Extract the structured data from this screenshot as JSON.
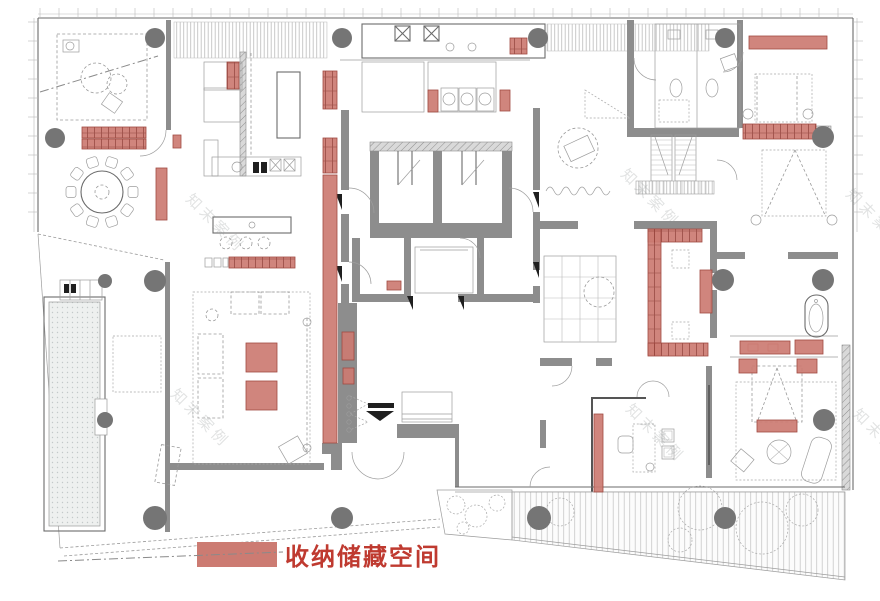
{
  "legend": {
    "label": "收纳储藏空间",
    "swatch_color": "#cc7b72",
    "text_color": "#bf3a30",
    "swatch": {
      "x": 197,
      "y": 542,
      "w": 80,
      "h": 25
    },
    "label_pos": {
      "x": 285,
      "y": 565
    },
    "leader": {
      "x1": 58,
      "y1": 561,
      "x2": 283,
      "y2": 552
    }
  },
  "palette": {
    "storage_fill": "#cc7b72",
    "storage_stroke": "#a14a42",
    "storage_dark": "#96423a",
    "wall": "#8d8d8d",
    "column": "#757575",
    "line": "#6b6b6b",
    "light": "#9d9d9d",
    "legend_text": "#bf3a30"
  },
  "watermark": {
    "text": "知末案例",
    "positions": [
      {
        "x": 185,
        "y": 200
      },
      {
        "x": 620,
        "y": 175
      },
      {
        "x": 845,
        "y": 195
      },
      {
        "x": 170,
        "y": 395
      },
      {
        "x": 625,
        "y": 410
      },
      {
        "x": 852,
        "y": 415
      }
    ]
  },
  "plan": {
    "storage_areas": [
      {
        "x": 82,
        "y": 127,
        "w": 64,
        "h": 11,
        "pattern": "stripe"
      },
      {
        "x": 82,
        "y": 139,
        "w": 64,
        "h": 10,
        "pattern": "stripe"
      },
      {
        "x": 173,
        "y": 135,
        "w": 8,
        "h": 13,
        "pattern": "solid"
      },
      {
        "x": 156,
        "y": 168,
        "w": 11,
        "h": 52,
        "pattern": "solid"
      },
      {
        "x": 227,
        "y": 62,
        "w": 12,
        "h": 27,
        "pattern": "stripe"
      },
      {
        "x": 323,
        "y": 71,
        "w": 14,
        "h": 38,
        "pattern": "stripe"
      },
      {
        "x": 323,
        "y": 138,
        "w": 14,
        "h": 35,
        "pattern": "stripe"
      },
      {
        "x": 323,
        "y": 175,
        "w": 14,
        "h": 268,
        "pattern": "solid"
      },
      {
        "x": 342,
        "y": 332,
        "w": 12,
        "h": 28,
        "pattern": "solid"
      },
      {
        "x": 343,
        "y": 368,
        "w": 11,
        "h": 16,
        "pattern": "solid"
      },
      {
        "x": 229,
        "y": 257,
        "w": 66,
        "h": 11,
        "pattern": "stripe"
      },
      {
        "x": 510,
        "y": 38,
        "w": 17,
        "h": 16,
        "pattern": "stripe"
      },
      {
        "x": 428,
        "y": 90,
        "w": 10,
        "h": 22,
        "pattern": "solid"
      },
      {
        "x": 500,
        "y": 90,
        "w": 10,
        "h": 21,
        "pattern": "solid"
      },
      {
        "x": 749,
        "y": 36,
        "w": 78,
        "h": 13,
        "pattern": "solid"
      },
      {
        "x": 743,
        "y": 124,
        "w": 73,
        "h": 15,
        "pattern": "stripe"
      },
      {
        "x": 648,
        "y": 229,
        "w": 54,
        "h": 13,
        "pattern": "stripe"
      },
      {
        "x": 648,
        "y": 229,
        "w": 13,
        "h": 126,
        "pattern": "stripe"
      },
      {
        "x": 648,
        "y": 343,
        "w": 60,
        "h": 13,
        "pattern": "stripe"
      },
      {
        "x": 700,
        "y": 270,
        "w": 12,
        "h": 43,
        "pattern": "solid"
      },
      {
        "x": 594,
        "y": 414,
        "w": 9,
        "h": 78,
        "pattern": "solid"
      },
      {
        "x": 246,
        "y": 343,
        "w": 31,
        "h": 29,
        "pattern": "solid"
      },
      {
        "x": 246,
        "y": 381,
        "w": 31,
        "h": 29,
        "pattern": "solid"
      },
      {
        "x": 740,
        "y": 341,
        "w": 50,
        "h": 13,
        "pattern": "solid"
      },
      {
        "x": 795,
        "y": 340,
        "w": 28,
        "h": 14,
        "pattern": "solid"
      },
      {
        "x": 739,
        "y": 359,
        "w": 18,
        "h": 14,
        "pattern": "solid"
      },
      {
        "x": 797,
        "y": 359,
        "w": 20,
        "h": 14,
        "pattern": "solid"
      },
      {
        "x": 757,
        "y": 420,
        "w": 40,
        "h": 12,
        "pattern": "solid"
      },
      {
        "x": 387,
        "y": 281,
        "w": 14,
        "h": 9,
        "pattern": "solid"
      }
    ],
    "columns": [
      {
        "cx": 155,
        "cy": 38,
        "r": 10
      },
      {
        "cx": 342,
        "cy": 38,
        "r": 10
      },
      {
        "cx": 538,
        "cy": 38,
        "r": 10
      },
      {
        "cx": 725,
        "cy": 38,
        "r": 10
      },
      {
        "cx": 55,
        "cy": 138,
        "r": 10
      },
      {
        "cx": 823,
        "cy": 137,
        "r": 11
      },
      {
        "cx": 105,
        "cy": 281,
        "r": 7
      },
      {
        "cx": 155,
        "cy": 281,
        "r": 11
      },
      {
        "cx": 105,
        "cy": 420,
        "r": 8
      },
      {
        "cx": 723,
        "cy": 280,
        "r": 11
      },
      {
        "cx": 823,
        "cy": 280,
        "r": 11
      },
      {
        "cx": 824,
        "cy": 420,
        "r": 11
      },
      {
        "cx": 155,
        "cy": 518,
        "r": 12
      },
      {
        "cx": 342,
        "cy": 518,
        "r": 11
      },
      {
        "cx": 539,
        "cy": 518,
        "r": 12
      },
      {
        "cx": 725,
        "cy": 518,
        "r": 11
      }
    ]
  }
}
